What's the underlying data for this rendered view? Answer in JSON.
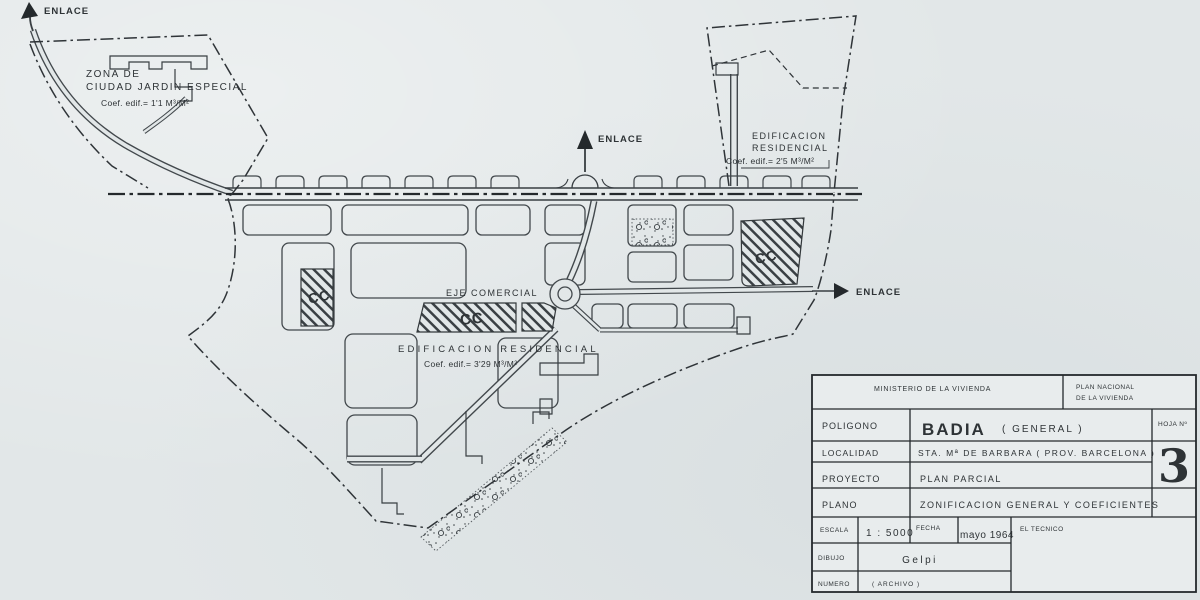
{
  "colors": {
    "paper": "#e2e7e8",
    "ink": "#33383b"
  },
  "map": {
    "enlace_top_left": "ENLACE",
    "enlace_top_center": "ENLACE",
    "enlace_right": "ENLACE",
    "zona_jardin": {
      "line1": "ZONA  DE",
      "line2": "CIUDAD JARDIN ESPECIAL",
      "coef": "Coef. edif.= 1'1 M³/M²"
    },
    "edificacion_residencial_right": {
      "line1": "EDIFICACION",
      "line2": "RESIDENCIAL",
      "coef": "Coef. edif.= 2'5 M³/M²"
    },
    "eje_comercial": "EJE COMERCIAL",
    "edificacion_residencial_center": {
      "line1": "EDIFICACION  RESIDENCIAL",
      "coef": "Coef. edif.= 3'29 M³/M²"
    },
    "cc_left": "CC",
    "cc_center": "CC",
    "cc_right": "CC"
  },
  "title_block": {
    "ministerio": "MINISTERIO  DE LA  VIVIENDA",
    "plan_nacional_line1": "PLAN  NACIONAL",
    "plan_nacional_line2": "DE  LA  VIVIENDA",
    "poligono_label": "POLIGONO",
    "poligono_value": "BADIA",
    "poligono_note": "( GENERAL )",
    "hoja_label": "HOJA Nº",
    "hoja_value": "3",
    "localidad_label": "LOCALIDAD",
    "localidad_value": "STA. Mª  DE  BARBARA    ( PROV.  BARCELONA )",
    "proyecto_label": "PROYECTO",
    "proyecto_value": "PLAN  PARCIAL",
    "plano_label": "PLANO",
    "plano_value": "ZONIFICACION  GENERAL  Y  COEFICIENTES",
    "escala_label": "ESCALA",
    "escala_value": "1 : 5000",
    "fecha_label": "FECHA",
    "fecha_value": "mayo 1964",
    "tecnico_label": "EL  TECNICO",
    "dibujo_label": "DIBUJO",
    "dibujo_value": "Gelpi",
    "numero_label": "NUMERO",
    "numero_value": "( ARCHIVO )"
  }
}
